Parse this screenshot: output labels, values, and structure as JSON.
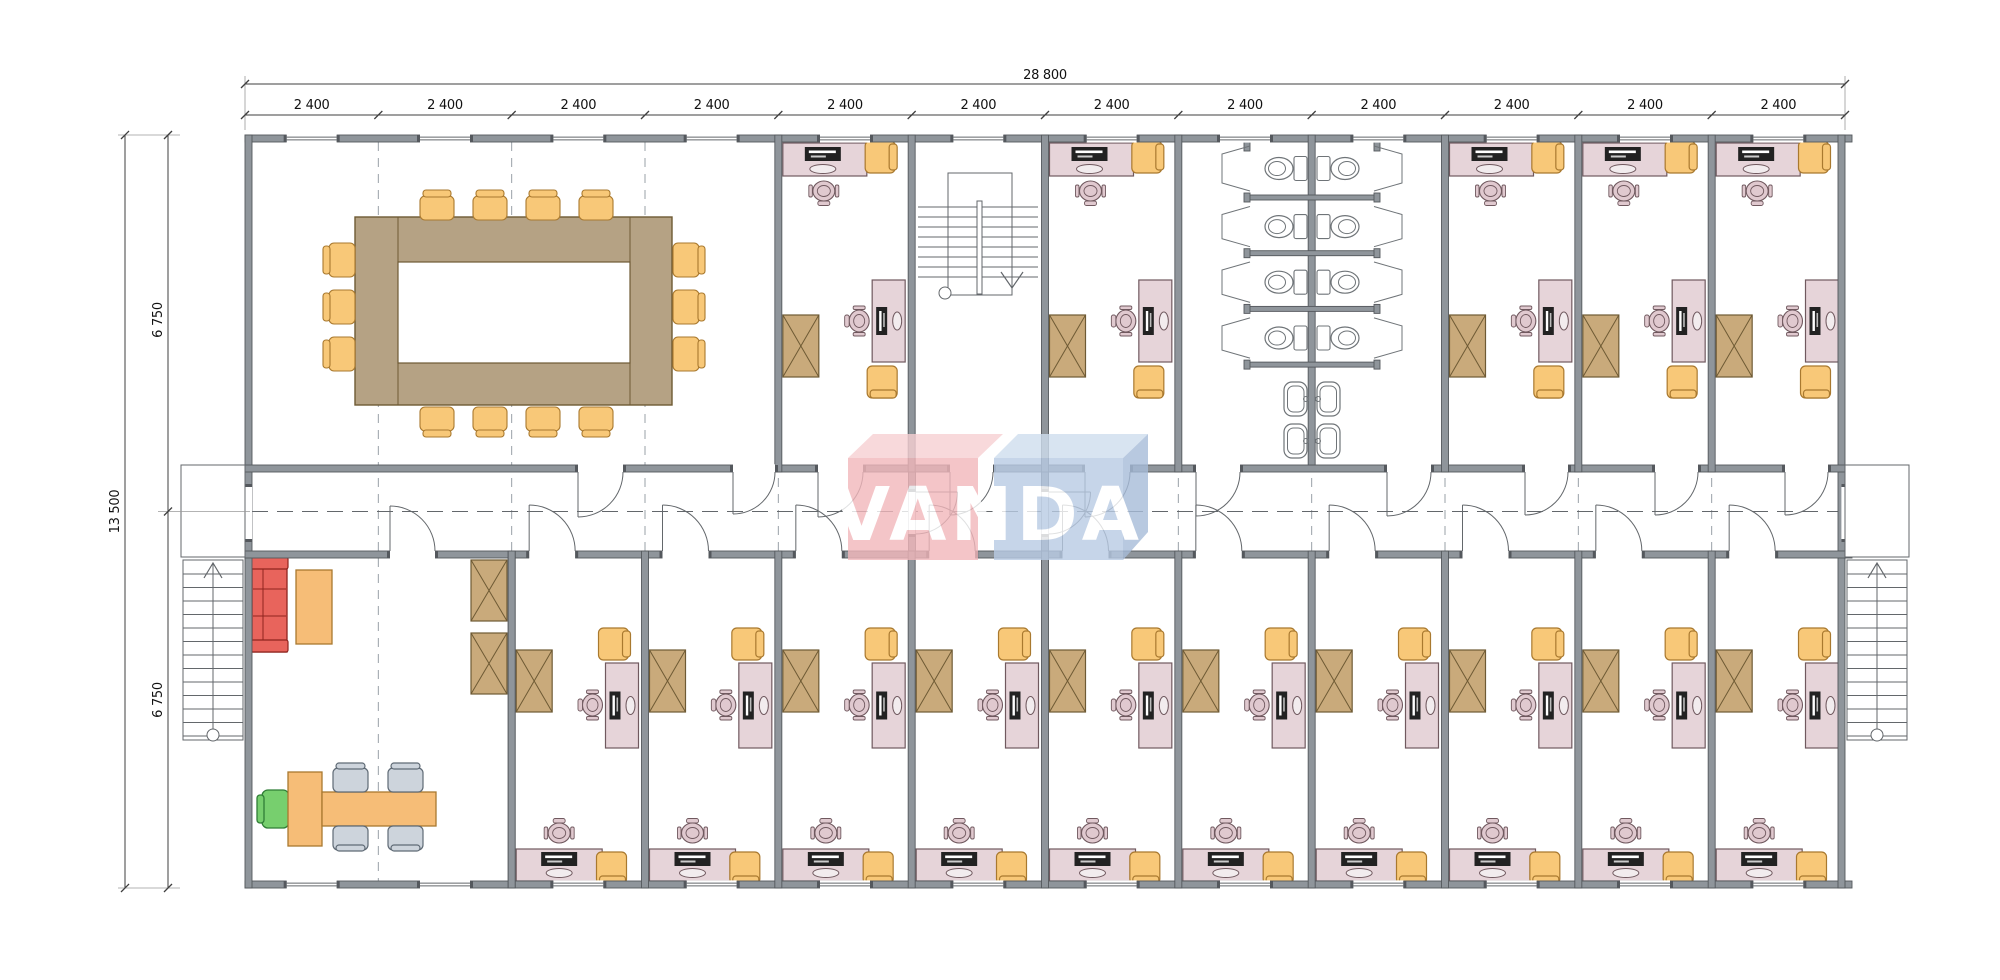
{
  "title": "Office building floor plan",
  "watermark": {
    "text": "VANDA",
    "front_left": "#f2b7bb",
    "top_left": "#f7d0d3",
    "front_right": "#b9cbe4",
    "top_right": "#cfdeee",
    "side_right": "#a7bcd9",
    "letter_color": "#ffffff"
  },
  "dimensions": {
    "overall_width_label": "28 800",
    "bay_label": "2 400",
    "bay_count": 12,
    "overall_depth_label": "13 500",
    "depth_top_label": "6 750",
    "depth_bottom_label": "6 750"
  },
  "colors": {
    "wall": "#8f959b",
    "wall_edge": "#54585d",
    "desk": "#e6d4d9",
    "desk_edge": "#70595f",
    "chair_seat": "#e0c9cf",
    "guest_chair": "#f8c878",
    "guest_chair_edge": "#a9792f",
    "cabinet": "#c9aa7b",
    "cabinet_edge": "#6e5a34",
    "table": "#b5a284",
    "table_edge": "#6e5a34",
    "sofa": "#e8645c",
    "sofa_edge": "#8f241e",
    "armchair_green": "#77cf6e",
    "armchair_green_edge": "#2f7d36",
    "visitor_chair_gray": "#cdd4dc",
    "visitor_chair_gray_edge": "#5f6a75",
    "reception_desk": "#f6bd77",
    "device": "#222222",
    "grid_dash": "#9aa0a7",
    "thin_line": "#63676b",
    "dim_line": "#3f3f3f",
    "dim_text": "#111111",
    "fixture": "#ffffff",
    "fixture_edge": "#6f7478"
  },
  "rooms": {
    "meeting_room": {
      "conference_chairs": {
        "top": 4,
        "bottom": 4,
        "left": 3,
        "right": 3
      }
    },
    "reception": {
      "sofas": 1,
      "coffee_tables": 1,
      "reception_desks": 1,
      "visitor_chairs": 4,
      "green_armchairs": 1,
      "cabinets": 2
    },
    "top_offices": {
      "count": 5
    },
    "bottom_offices": {
      "count": 10
    },
    "toilets": {
      "stall_rows": 4,
      "stalls": 8,
      "basin_pairs": 2
    },
    "stairwells": {
      "internal": 1,
      "external": 2
    }
  }
}
